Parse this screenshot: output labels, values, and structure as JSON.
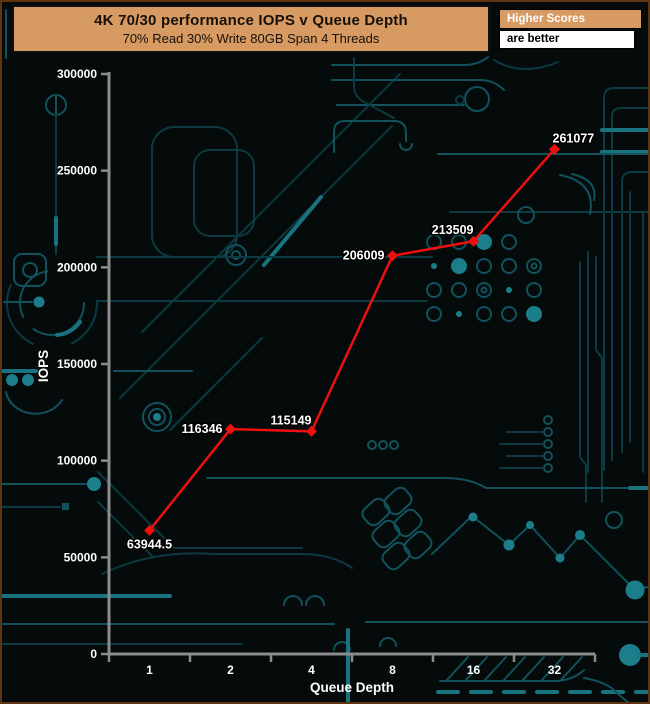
{
  "header": {
    "title": "4K 70/30 performance IOPS v Queue Depth",
    "subtitle": "70% Read 30% Write 80GB Span 4 Threads"
  },
  "note": {
    "line1": "Higher Scores",
    "line2": "are better"
  },
  "colors": {
    "background": "#050a0a",
    "frame_border": "#5e3411",
    "header_bg": "#d69a62",
    "header_text": "#17100a",
    "note_text_top": "#ffffff",
    "note_text_bottom": "#000000",
    "series_red": "#ee0f0f",
    "axis_gray": "#8c8c8c",
    "label_white": "#ffffff",
    "trace_teal_dark": "#0c3a42",
    "trace_teal_bright": "#18737f"
  },
  "chart_data": {
    "type": "line",
    "title": "4K 70/30 performance IOPS v Queue Depth",
    "subtitle": "70% Read 30% Write 80GB Span 4 Threads",
    "xlabel": "Queue Depth",
    "ylabel": "IOPS",
    "x_scale": "categorical (queue depth doublings)",
    "categories": [
      "1",
      "2",
      "4",
      "8",
      "16",
      "32"
    ],
    "values": [
      63944.5,
      116346,
      115149,
      206009,
      213509,
      261077
    ],
    "point_labels": [
      "63944.5",
      "116346",
      "115149",
      "206009",
      "213509",
      "261077"
    ],
    "label_positions": [
      "below",
      "left",
      "above-left",
      "left",
      "above-left",
      "above-right"
    ],
    "ylim": [
      0,
      300000
    ],
    "ytick_step": 50000,
    "yticks": [
      "0",
      "50000",
      "100000",
      "150000",
      "200000",
      "250000",
      "300000"
    ],
    "grid": false,
    "legend": null,
    "marker": "diamond",
    "series_name": "IOPS"
  }
}
